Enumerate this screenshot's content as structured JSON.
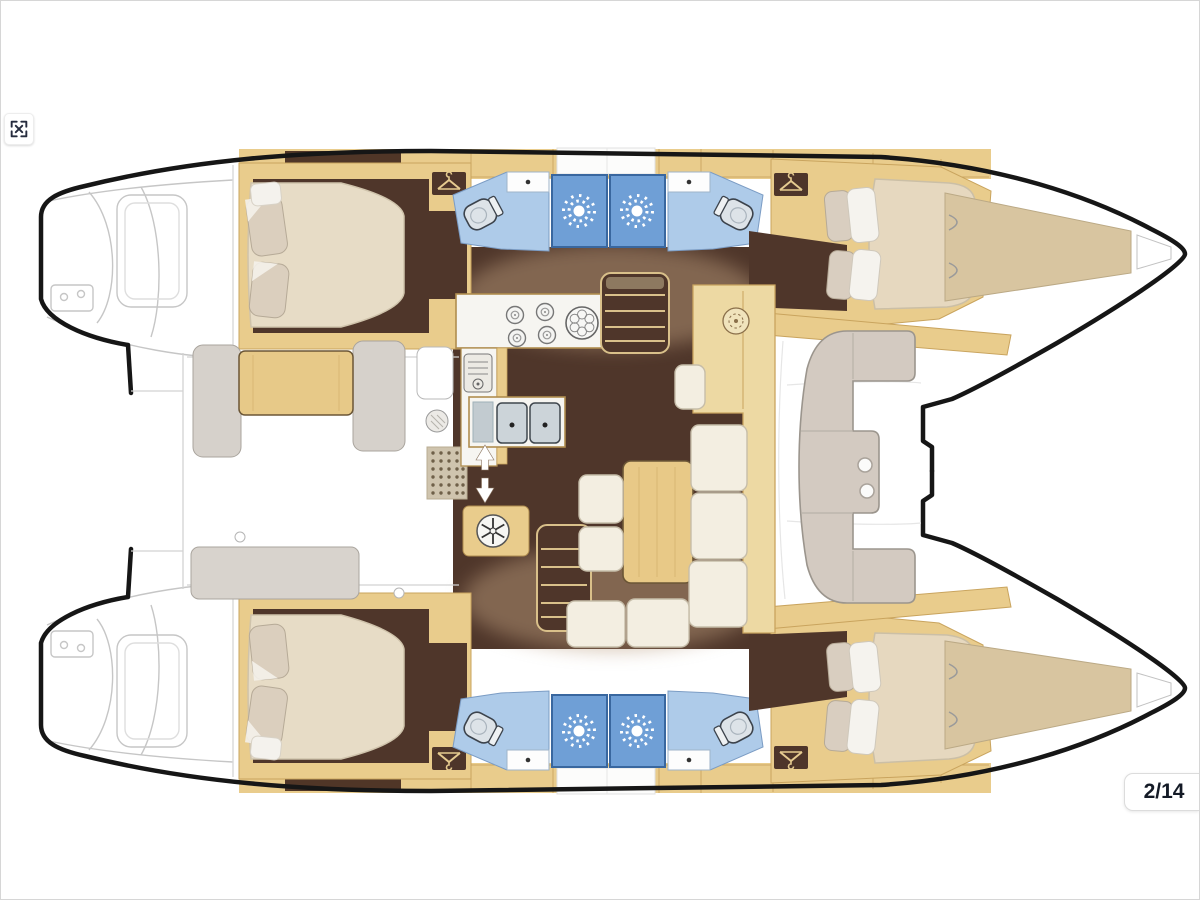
{
  "viewer": {
    "background_color": "#ffffff",
    "fullscreen_button": {
      "icon": "expand-arrows",
      "tooltip": "Fullscreen"
    },
    "page_indicator": {
      "text": "2/14",
      "current": 2,
      "total": 14
    }
  },
  "floor_plan": {
    "kind": "catamaran-deck-plan",
    "orientation": "bow-right",
    "hulls": [
      "port",
      "starboard"
    ],
    "rooms": [
      {
        "id": "port-aft-cabin",
        "type": "double-berth-cabin"
      },
      {
        "id": "port-aft-bathroom",
        "type": "toilet-and-sink"
      },
      {
        "id": "port-shower",
        "type": "shower-stall"
      },
      {
        "id": "port-forward-cabin",
        "type": "double-berth-cabin"
      },
      {
        "id": "port-forward-bathroom",
        "type": "toilet-and-sink"
      },
      {
        "id": "starboard-aft-cabin",
        "type": "double-berth-cabin"
      },
      {
        "id": "starboard-aft-bathroom",
        "type": "toilet-and-sink"
      },
      {
        "id": "starboard-shower",
        "type": "shower-stall"
      },
      {
        "id": "starboard-forward-cabin",
        "type": "double-berth-cabin"
      },
      {
        "id": "starboard-forward-bathroom",
        "type": "toilet-and-sink"
      },
      {
        "id": "saloon-dinette",
        "type": "table-with-settee"
      },
      {
        "id": "galley",
        "type": "stove-and-double-sink"
      },
      {
        "id": "aft-cockpit",
        "type": "cockpit-table-and-benches"
      },
      {
        "id": "forward-cockpit",
        "type": "c-shaped-bench"
      },
      {
        "id": "swim-platforms",
        "type": "stern-steps"
      },
      {
        "id": "bows",
        "type": "bow-lockers"
      }
    ],
    "colors": {
      "hull_outline": "#161616",
      "wood_trim": "#e9cc8c",
      "wood_seam": "#c9a45e",
      "cabin_floor": "#4f362a",
      "floor_highlight": "#b59677",
      "bathroom_blue": "#aecbe9",
      "shower_blue": "#6f9fd6",
      "mattress_cream": "#e7dcc6",
      "cushion_cream": "#f3eee1",
      "bench_gray": "#d3cac1",
      "table_wood": "#e8c987",
      "bow_deck": "#d8c5a0"
    }
  }
}
